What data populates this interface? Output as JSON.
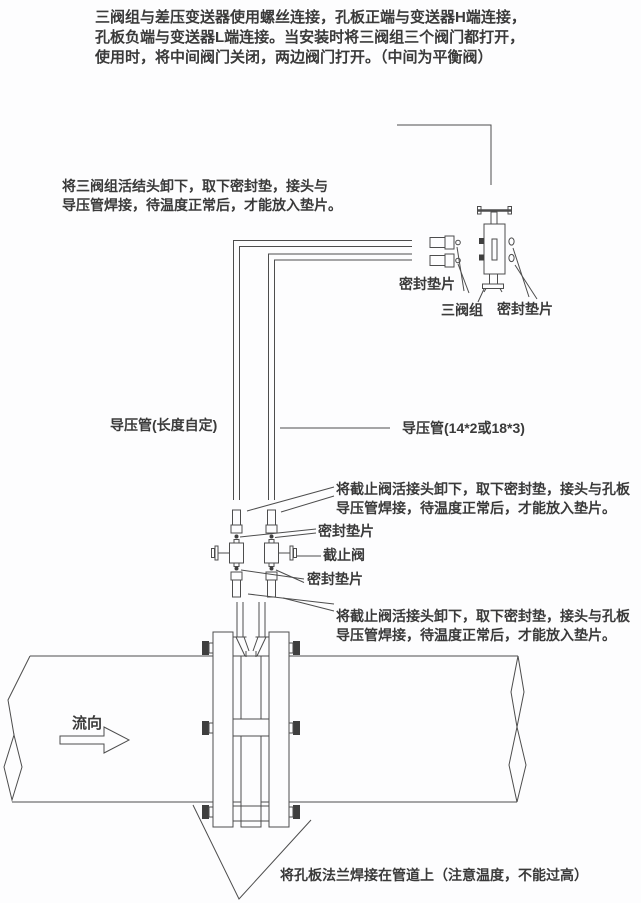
{
  "page": {
    "background": "#fdfdfe",
    "line_color": "#4d4d4d",
    "text_color": "#3a3a3a"
  },
  "notes": {
    "top_paragraph": {
      "lines": [
        "三阀组与差压变送器使用螺丝连接，孔板正端与变送器H端连接，",
        "孔板负端与变送器L端连接。当安装时将三阀组三个阀门都打开，",
        "使用时，将中间阀门关闭，两边阀门打开。（中间为平衡阀）"
      ]
    },
    "manifold_note": {
      "lines": [
        "将三阀组活结头卸下，取下密封垫，接头与",
        "导压管焊接，待温度正常后，才能放入垫片。"
      ]
    },
    "upper_valve_note": {
      "lines": [
        "将截止阀活接头卸下，取下密封垫，接头与孔板",
        "导压管焊接，待温度正常后，才能放入垫片。"
      ]
    },
    "lower_valve_note": {
      "lines": [
        "将截止阀活接头卸下，取下密封垫，接头与孔板",
        "导压管焊接，待温度正常后，才能放入垫片。"
      ]
    },
    "bottom_note": "将孔板法兰焊接在管道上（注意温度，不能过高）"
  },
  "labels": {
    "seal_gasket_top_left": "密封垫片",
    "three_valve_manifold": "三阀组",
    "seal_gasket_top_right": "密封垫片",
    "impulse_pipe_left": "导压管(长度自定)",
    "impulse_pipe_right": "导压管(14*2或18*3)",
    "seal_gasket_valve_top": "密封垫片",
    "shutoff_valve": "截止阀",
    "seal_gasket_valve_bottom": "密封垫片",
    "flow_direction": "流向"
  }
}
